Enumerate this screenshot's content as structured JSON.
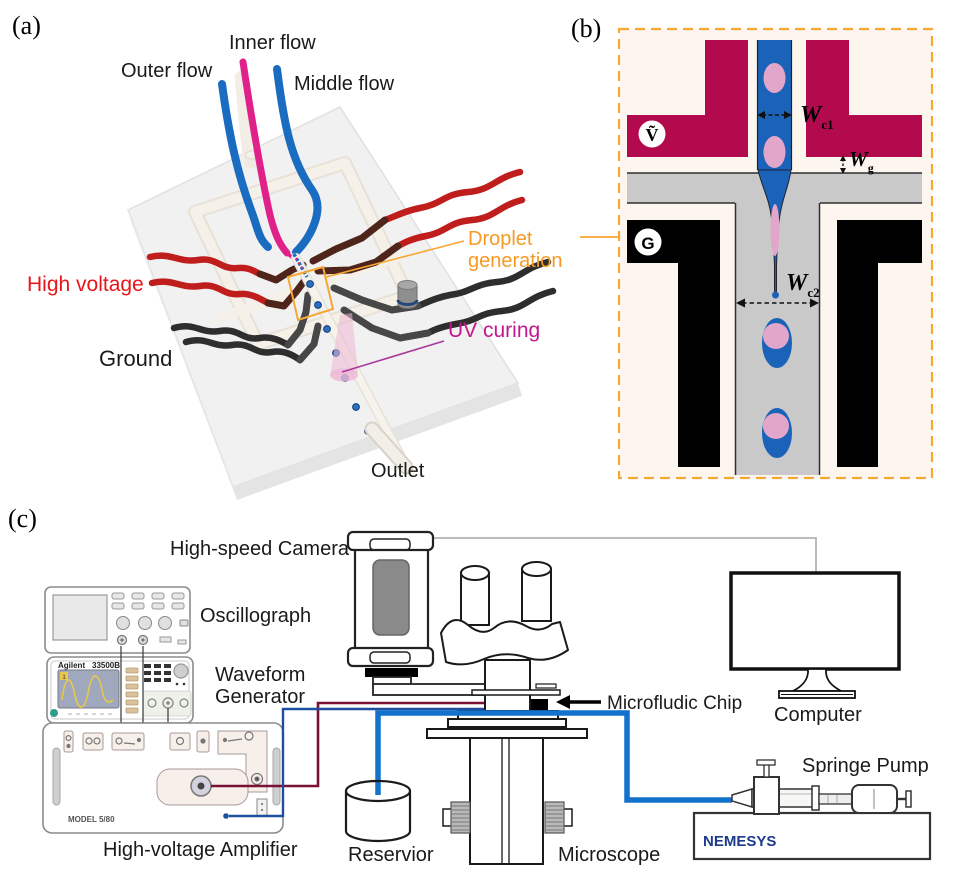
{
  "figure": {
    "panel_a_tag": "(a)",
    "panel_b_tag": "(b)",
    "panel_c_tag": "(c)"
  },
  "panel_a": {
    "labels": {
      "inner_flow": "Inner flow",
      "outer_flow": "Outer flow",
      "middle_flow": "Middle flow",
      "high_voltage": "High voltage",
      "ground": "Ground",
      "droplet_generation_line1": "Droplet",
      "droplet_generation_line2": "generation",
      "uv_curing": "UV curing",
      "outlet": "Outlet"
    },
    "colors": {
      "high_voltage_text": "#e8151b",
      "droplet_generation_text": "#f59a23",
      "uv_curing_text": "#c2188c"
    }
  },
  "panel_b": {
    "labels": {
      "voltage_symbol": "Ṽ",
      "ground_symbol": "G",
      "w_c1_main": "W",
      "w_c1_sub": "c1",
      "w_g_main": "W",
      "w_g_sub": "g",
      "w_c2_main": "W",
      "w_c2_sub": "c2"
    },
    "colors": {
      "hv_electrode": "#b3094d",
      "ground_electrode": "#000000",
      "disperse_phase": "#1b63b8",
      "droplet_core": "#e2a6ca",
      "channel_gray": "#c9c9c9",
      "frame_orange": "#f7a733",
      "background_cream": "#fdf6ee"
    }
  },
  "panel_c": {
    "labels": {
      "high_speed_camera": "High-speed Camera",
      "oscillograph": "Oscillograph",
      "waveform_line1": "Waveform",
      "waveform_line2": "Generator",
      "high_voltage_amplifier": "High-voltage Amplifier",
      "reservoir": "Reservior",
      "microscope": "Microscope",
      "microfluidic_chip": "Microfludic Chip",
      "computer": "Computer",
      "syringe_pump": "Springe Pump"
    },
    "device_text": {
      "waveform_brand": "Agilent",
      "waveform_model": "33500B",
      "waveform_channel": "1",
      "amplifier_model": "MODEL 5/80",
      "pump_brand": "NEMESYS"
    },
    "colors": {
      "tube_blue": "#1272cc",
      "hv_wire": "#7a1033",
      "signal_wire": "#1d4ea0",
      "camera_cable": "#b3b3b3",
      "pump_brand_text": "#1e3a8c"
    }
  }
}
